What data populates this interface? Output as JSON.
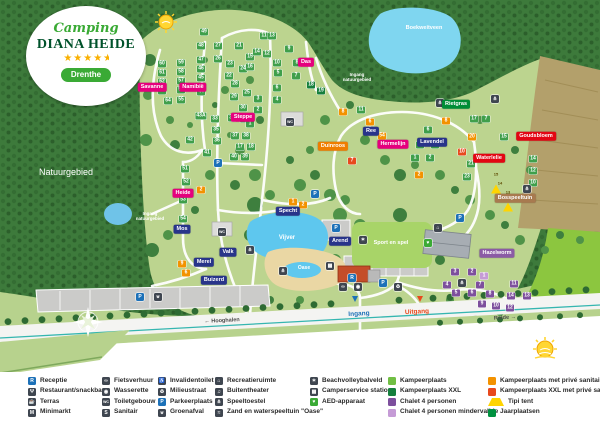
{
  "logo": {
    "script": "Camping",
    "title": "DIANA HEIDE",
    "stars": "★★★★",
    "star_half": "★",
    "region": "Drenthe"
  },
  "map": {
    "white_labels": [
      {
        "t": "Natuurgebied",
        "x": 66,
        "y": 172,
        "fs": 9,
        "fw": 400
      },
      {
        "t": "Boekweitveen",
        "x": 424,
        "y": 28,
        "fs": 5.5,
        "fw": 700
      },
      {
        "t": "Vijver",
        "x": 287,
        "y": 238,
        "fs": 6,
        "fw": 700
      },
      {
        "t": "Oase",
        "x": 304,
        "y": 268,
        "fs": 5,
        "fw": 700
      },
      {
        "t": "Sport en spel",
        "x": 391,
        "y": 243,
        "fs": 5.5,
        "fw": 700
      },
      {
        "t": "Ingang\nnatuurgebied",
        "x": 150,
        "y": 216,
        "fs": 4.5,
        "fw": 700
      },
      {
        "t": "Ingang\nnatuurgebied",
        "x": 357,
        "y": 77,
        "fs": 4.5,
        "fw": 700
      }
    ],
    "area_labels": [
      {
        "t": "Savanne",
        "x": 152,
        "y": 87,
        "c": "#e5007d"
      },
      {
        "t": "Namibië",
        "x": 193,
        "y": 87,
        "c": "#e5007d"
      },
      {
        "t": "Steppe",
        "x": 243,
        "y": 117,
        "c": "#e5007d"
      },
      {
        "t": "Heide",
        "x": 183,
        "y": 193,
        "c": "#e5007d"
      },
      {
        "t": "Das",
        "x": 306,
        "y": 62,
        "c": "#e5007d"
      },
      {
        "t": "Hermelijn",
        "x": 393,
        "y": 144,
        "c": "#e5007d"
      },
      {
        "t": "Duinroos",
        "x": 333,
        "y": 146,
        "c": "#ef7d00"
      },
      {
        "t": "Ree",
        "x": 371,
        "y": 131,
        "c": "#28348a"
      },
      {
        "t": "Specht",
        "x": 288,
        "y": 211,
        "c": "#28348a"
      },
      {
        "t": "Arend",
        "x": 340,
        "y": 241,
        "c": "#28348a"
      },
      {
        "t": "Mos",
        "x": 182,
        "y": 229,
        "c": "#28348a"
      },
      {
        "t": "Merel",
        "x": 204,
        "y": 262,
        "c": "#28348a"
      },
      {
        "t": "Valk",
        "x": 228,
        "y": 252,
        "c": "#28348a"
      },
      {
        "t": "Buizerd",
        "x": 214,
        "y": 280,
        "c": "#28348a"
      },
      {
        "t": "Lavendel",
        "x": 432,
        "y": 142,
        "c": "#28348a"
      },
      {
        "t": "Rietgras",
        "x": 456,
        "y": 104,
        "c": "#008d36"
      },
      {
        "t": "Waterlelie",
        "x": 489,
        "y": 158,
        "c": "#e30613"
      },
      {
        "t": "Goudsbloem",
        "x": 536,
        "y": 136,
        "c": "#e30613"
      },
      {
        "t": "Bosspeeltuin",
        "x": 515,
        "y": 198,
        "c": "#a87a4f"
      },
      {
        "t": "Hazelworm",
        "x": 497,
        "y": 253,
        "c": "#8b5ba5"
      }
    ],
    "road_labels": [
      {
        "t": "← Hooghalen",
        "x": 222,
        "y": 321,
        "c": "#4a4a4a",
        "rot": -3,
        "fs": 5.5
      },
      {
        "t": "Rolde →",
        "x": 505,
        "y": 318,
        "c": "#4a4a4a",
        "rot": -4,
        "fs": 5.5
      },
      {
        "t": "Ingang",
        "x": 359,
        "y": 314,
        "c": "#1d71b8",
        "rot": -3,
        "fs": 6.5
      },
      {
        "t": "Uitgang",
        "x": 417,
        "y": 312,
        "c": "#e8491d",
        "rot": -3,
        "fs": 6.5
      }
    ],
    "plots": [
      [
        "49",
        204,
        32,
        "g"
      ],
      [
        "48",
        201,
        46,
        "g"
      ],
      [
        "60",
        162,
        64,
        "g"
      ],
      [
        "59",
        181,
        63,
        "g"
      ],
      [
        "47",
        201,
        60,
        "g"
      ],
      [
        "61",
        162,
        73,
        "g"
      ],
      [
        "58",
        181,
        72,
        "g"
      ],
      [
        "46",
        201,
        69,
        "g"
      ],
      [
        "62",
        162,
        82,
        "g"
      ],
      [
        "57",
        181,
        81,
        "g"
      ],
      [
        "45",
        201,
        78,
        "g"
      ],
      [
        "63",
        162,
        91,
        "g"
      ],
      [
        "56",
        181,
        90,
        "g"
      ],
      [
        "44",
        201,
        92,
        "g"
      ],
      [
        "64",
        168,
        101,
        "g"
      ],
      [
        "55",
        181,
        100,
        "g"
      ],
      [
        "43A",
        201,
        116,
        "g"
      ],
      [
        "42",
        190,
        140,
        "g"
      ],
      [
        "41",
        207,
        153,
        "g"
      ],
      [
        "51",
        185,
        169,
        "g"
      ],
      [
        "52",
        186,
        182,
        "g"
      ],
      [
        "53",
        183,
        200,
        "g"
      ],
      [
        "54",
        183,
        219,
        "g"
      ],
      [
        "27",
        218,
        46,
        "g"
      ],
      [
        "21",
        239,
        46,
        "g"
      ],
      [
        "26",
        218,
        59,
        "g"
      ],
      [
        "23",
        230,
        64,
        "g"
      ],
      [
        "24",
        243,
        69,
        "g"
      ],
      [
        "22",
        229,
        76,
        "g"
      ],
      [
        "28",
        235,
        84,
        "g"
      ],
      [
        "25",
        247,
        93,
        "g"
      ],
      [
        "29",
        234,
        97,
        "g"
      ],
      [
        "30",
        243,
        108,
        "g"
      ],
      [
        "33",
        215,
        119,
        "g"
      ],
      [
        "34",
        232,
        118,
        "g"
      ],
      [
        "32",
        244,
        119,
        "g"
      ],
      [
        "35",
        216,
        130,
        "g"
      ],
      [
        "36",
        217,
        141,
        "g"
      ],
      [
        "1",
        250,
        124,
        "g"
      ],
      [
        "37",
        235,
        136,
        "g"
      ],
      [
        "38",
        246,
        136,
        "g"
      ],
      [
        "17",
        240,
        147,
        "g"
      ],
      [
        "18",
        251,
        147,
        "g"
      ],
      [
        "40",
        234,
        157,
        "g"
      ],
      [
        "39",
        245,
        157,
        "g"
      ],
      [
        "11",
        264,
        36,
        "g"
      ],
      [
        "13",
        272,
        36,
        "g"
      ],
      [
        "15",
        250,
        57,
        "g"
      ],
      [
        "14",
        257,
        52,
        "g"
      ],
      [
        "12",
        267,
        54,
        "g"
      ],
      [
        "16",
        250,
        67,
        "g"
      ],
      [
        "9",
        289,
        49,
        "g"
      ],
      [
        "10",
        277,
        63,
        "g"
      ],
      [
        "8",
        297,
        63,
        "g"
      ],
      [
        "5",
        278,
        73,
        "g"
      ],
      [
        "7",
        296,
        76,
        "g"
      ],
      [
        "6",
        277,
        88,
        "g"
      ],
      [
        "4",
        277,
        100,
        "g"
      ],
      [
        "3",
        258,
        99,
        "g"
      ],
      [
        "2",
        258,
        110,
        "g"
      ],
      [
        "18",
        311,
        85,
        "x"
      ],
      [
        "19",
        321,
        91,
        "x"
      ],
      [
        "11",
        361,
        110,
        "g"
      ],
      [
        "5",
        370,
        130,
        "g"
      ],
      [
        "6",
        428,
        130,
        "g"
      ],
      [
        "3",
        420,
        145,
        "g"
      ],
      [
        "4",
        435,
        145,
        "g"
      ],
      [
        "1",
        415,
        158,
        "g"
      ],
      [
        "2",
        430,
        158,
        "g"
      ],
      [
        "17",
        474,
        119,
        "g"
      ],
      [
        "7",
        486,
        119,
        "g"
      ],
      [
        "15",
        504,
        137,
        "g"
      ],
      [
        "21",
        471,
        164,
        "g"
      ],
      [
        "23",
        467,
        177,
        "g"
      ],
      [
        "14",
        533,
        159,
        "g"
      ],
      [
        "12",
        533,
        171,
        "g"
      ],
      [
        "10",
        533,
        183,
        "g"
      ],
      [
        "8",
        343,
        112,
        "o"
      ],
      [
        "6",
        370,
        122,
        "o"
      ],
      [
        "54",
        382,
        136,
        "o"
      ],
      [
        "8",
        446,
        121,
        "o"
      ],
      [
        "20",
        472,
        137,
        "o"
      ],
      [
        "2",
        201,
        190,
        "o"
      ],
      [
        "1",
        293,
        202,
        "o"
      ],
      [
        "2",
        303,
        205,
        "o"
      ],
      [
        "9",
        182,
        264,
        "o"
      ],
      [
        "6",
        186,
        273,
        "o"
      ],
      [
        "2",
        419,
        175,
        "o"
      ],
      [
        "7",
        352,
        161,
        "d"
      ],
      [
        "10",
        462,
        152,
        "d"
      ],
      [
        "15",
        496,
        172,
        "t"
      ],
      [
        "14",
        500,
        181,
        "t"
      ],
      [
        "13",
        508,
        190,
        "t"
      ],
      [
        "3",
        455,
        272,
        "p"
      ],
      [
        "2",
        472,
        272,
        "p"
      ],
      [
        "1",
        484,
        276,
        "lp"
      ],
      [
        "4",
        447,
        285,
        "p"
      ],
      [
        "7",
        480,
        285,
        "p"
      ],
      [
        "11",
        514,
        284,
        "p"
      ],
      [
        "5",
        456,
        293,
        "p"
      ],
      [
        "6",
        472,
        293,
        "p"
      ],
      [
        "8",
        490,
        294,
        "p"
      ],
      [
        "14",
        511,
        296,
        "p"
      ],
      [
        "13",
        527,
        296,
        "p"
      ],
      [
        "9",
        482,
        304,
        "p"
      ],
      [
        "10",
        496,
        306,
        "p"
      ],
      [
        "12",
        510,
        308,
        "p"
      ]
    ],
    "facilities": [
      {
        "g": "P",
        "x": 218,
        "y": 163,
        "c": "#1d71b8",
        "name": "parking-icon"
      },
      {
        "g": "P",
        "x": 315,
        "y": 194,
        "c": "#1d71b8",
        "name": "parking-icon"
      },
      {
        "g": "P",
        "x": 336,
        "y": 228,
        "c": "#1d71b8",
        "name": "parking-icon"
      },
      {
        "g": "P",
        "x": 383,
        "y": 283,
        "c": "#1d71b8",
        "name": "parking-icon"
      },
      {
        "g": "P",
        "x": 140,
        "y": 297,
        "c": "#1d71b8",
        "name": "parking-icon"
      },
      {
        "g": "P",
        "x": 460,
        "y": 218,
        "c": "#1d71b8",
        "name": "parking-icon"
      },
      {
        "g": "R",
        "x": 352,
        "y": 278,
        "c": "#1d71b8",
        "name": "reception-icon"
      },
      {
        "g": "WC",
        "x": 222,
        "y": 232,
        "c": "#3f4650",
        "name": "toilet-building-icon"
      },
      {
        "g": "WC",
        "x": 290,
        "y": 122,
        "c": "#3f4650",
        "name": "toilet-building-icon"
      },
      {
        "g": "⊎",
        "x": 158,
        "y": 297,
        "c": "#3f4650",
        "name": "green-waste-icon"
      },
      {
        "g": "⋔",
        "x": 250,
        "y": 250,
        "c": "#3f4650",
        "name": "playground-icon"
      },
      {
        "g": "⋔",
        "x": 283,
        "y": 271,
        "c": "#3f4650",
        "name": "playground-icon"
      },
      {
        "g": "⋔",
        "x": 440,
        "y": 103,
        "c": "#3f4650",
        "name": "playground-icon"
      },
      {
        "g": "⋔",
        "x": 495,
        "y": 99,
        "c": "#3f4650",
        "name": "playground-icon"
      },
      {
        "g": "⋔",
        "x": 527,
        "y": 189,
        "c": "#3f4650",
        "name": "playground-icon"
      },
      {
        "g": "⋔",
        "x": 462,
        "y": 283,
        "c": "#3f4650",
        "name": "playground-icon"
      },
      {
        "g": "✶",
        "x": 363,
        "y": 240,
        "c": "#3f4650",
        "name": "beach-volleyball-icon"
      },
      {
        "g": "⌂",
        "x": 438,
        "y": 228,
        "c": "#3f4650",
        "name": "recreation-room-icon"
      },
      {
        "g": "▦",
        "x": 330,
        "y": 266,
        "c": "#3f4650",
        "name": "camper-service-icon"
      },
      {
        "g": "∞",
        "x": 343,
        "y": 287,
        "c": "#3f4650",
        "name": "bike-rental-icon"
      },
      {
        "g": "◉",
        "x": 358,
        "y": 287,
        "c": "#3f4650",
        "name": "laundry-icon"
      },
      {
        "g": "♻",
        "x": 398,
        "y": 287,
        "c": "#3f4650",
        "name": "recycling-icon"
      },
      {
        "g": "♥",
        "x": 428,
        "y": 243,
        "c": "#3aaa35",
        "name": "aed-icon"
      }
    ]
  },
  "legend": {
    "columns": [
      {
        "x": 28,
        "items": [
          {
            "g": "R",
            "c": "#1d71b8",
            "label": "Receptie",
            "name": "receptie"
          },
          {
            "g": "Ψ",
            "c": "#3f4650",
            "label": "Restaurant/snackbar",
            "name": "restaurant"
          },
          {
            "g": "☕",
            "c": "#3f4650",
            "label": "Terras",
            "name": "terras"
          },
          {
            "g": "M",
            "c": "#3f4650",
            "label": "Minimarkt",
            "name": "minimarkt"
          }
        ]
      },
      {
        "x": 102,
        "items": [
          {
            "g": "∞",
            "c": "#3f4650",
            "label": "Fietsverhuur",
            "name": "fietsverhuur"
          },
          {
            "g": "◉",
            "c": "#3f4650",
            "label": "Wasserette",
            "name": "wasserette"
          },
          {
            "g": "WC",
            "c": "#3f4650",
            "label": "Toiletgebouw",
            "name": "toiletgebouw"
          },
          {
            "g": "S",
            "c": "#3f4650",
            "label": "Sanitair",
            "name": "sanitair"
          }
        ]
      },
      {
        "x": 158,
        "items": [
          {
            "g": "♿",
            "c": "#3f4650",
            "label": "Invalidentoilet",
            "name": "invalidentoilet"
          },
          {
            "g": "♻",
            "c": "#3f4650",
            "label": "Milieustraat",
            "name": "milieustraat"
          },
          {
            "g": "P",
            "c": "#1d71b8",
            "label": "Parkeerplaats",
            "name": "parkeerplaats"
          },
          {
            "g": "⊎",
            "c": "#3f4650",
            "label": "Groenafval",
            "name": "groenafval"
          }
        ]
      },
      {
        "x": 215,
        "items": [
          {
            "g": "⌂",
            "c": "#3f4650",
            "label": "Recreatieruimte",
            "name": "recreatieruimte"
          },
          {
            "g": "♫",
            "c": "#3f4650",
            "label": "Buitentheater",
            "name": "buitentheater"
          },
          {
            "g": "⋔",
            "c": "#3f4650",
            "label": "Speeltoestel",
            "name": "speeltoestel"
          },
          {
            "g": "≈",
            "c": "#3f4650",
            "label": "Zand en waterspeeltuin \"Oase\"",
            "name": "zand-waterspeeltuin"
          }
        ]
      },
      {
        "x": 310,
        "items": [
          {
            "g": "✶",
            "c": "#3f4650",
            "label": "Beachvolleybalveld",
            "name": "beachvolleybalveld"
          },
          {
            "g": "▦",
            "c": "#3f4650",
            "label": "Camperservice station",
            "name": "camperservice"
          },
          {
            "g": "♥",
            "c": "#3aaa35",
            "label": "AED-apparaat",
            "name": "aed"
          }
        ]
      },
      {
        "x": 388,
        "items": [
          {
            "swatch": "#71bf44",
            "label": "Kampeerplaats",
            "name": "kampeerplaats"
          },
          {
            "swatch": "#157f3d",
            "label": "Kampeerplaats XXL",
            "name": "kampeerplaats-xxl"
          },
          {
            "swatch": "#7d4f9d",
            "label": "Chalet 4 personen",
            "name": "chalet"
          },
          {
            "swatch": "#c59bd6",
            "label": "Chalet 4 personen mindervalide",
            "name": "chalet-mindervalide"
          }
        ]
      },
      {
        "x": 488,
        "items": [
          {
            "swatch": "#f39200",
            "label": "Kampeerplaats met privé sanitair",
            "name": "kampeerplaats-prive"
          },
          {
            "swatch": "#e8491d",
            "label": "Kampeerplaats XXL met privé sanitair",
            "name": "kampeerplaats-xxl-prive"
          },
          {
            "tri": true,
            "label": "Tipi tent",
            "name": "tipi-tent"
          },
          {
            "swatch": "#00913f",
            "label": "Jaarplaatsen",
            "name": "jaarplaatsen"
          }
        ]
      }
    ]
  }
}
